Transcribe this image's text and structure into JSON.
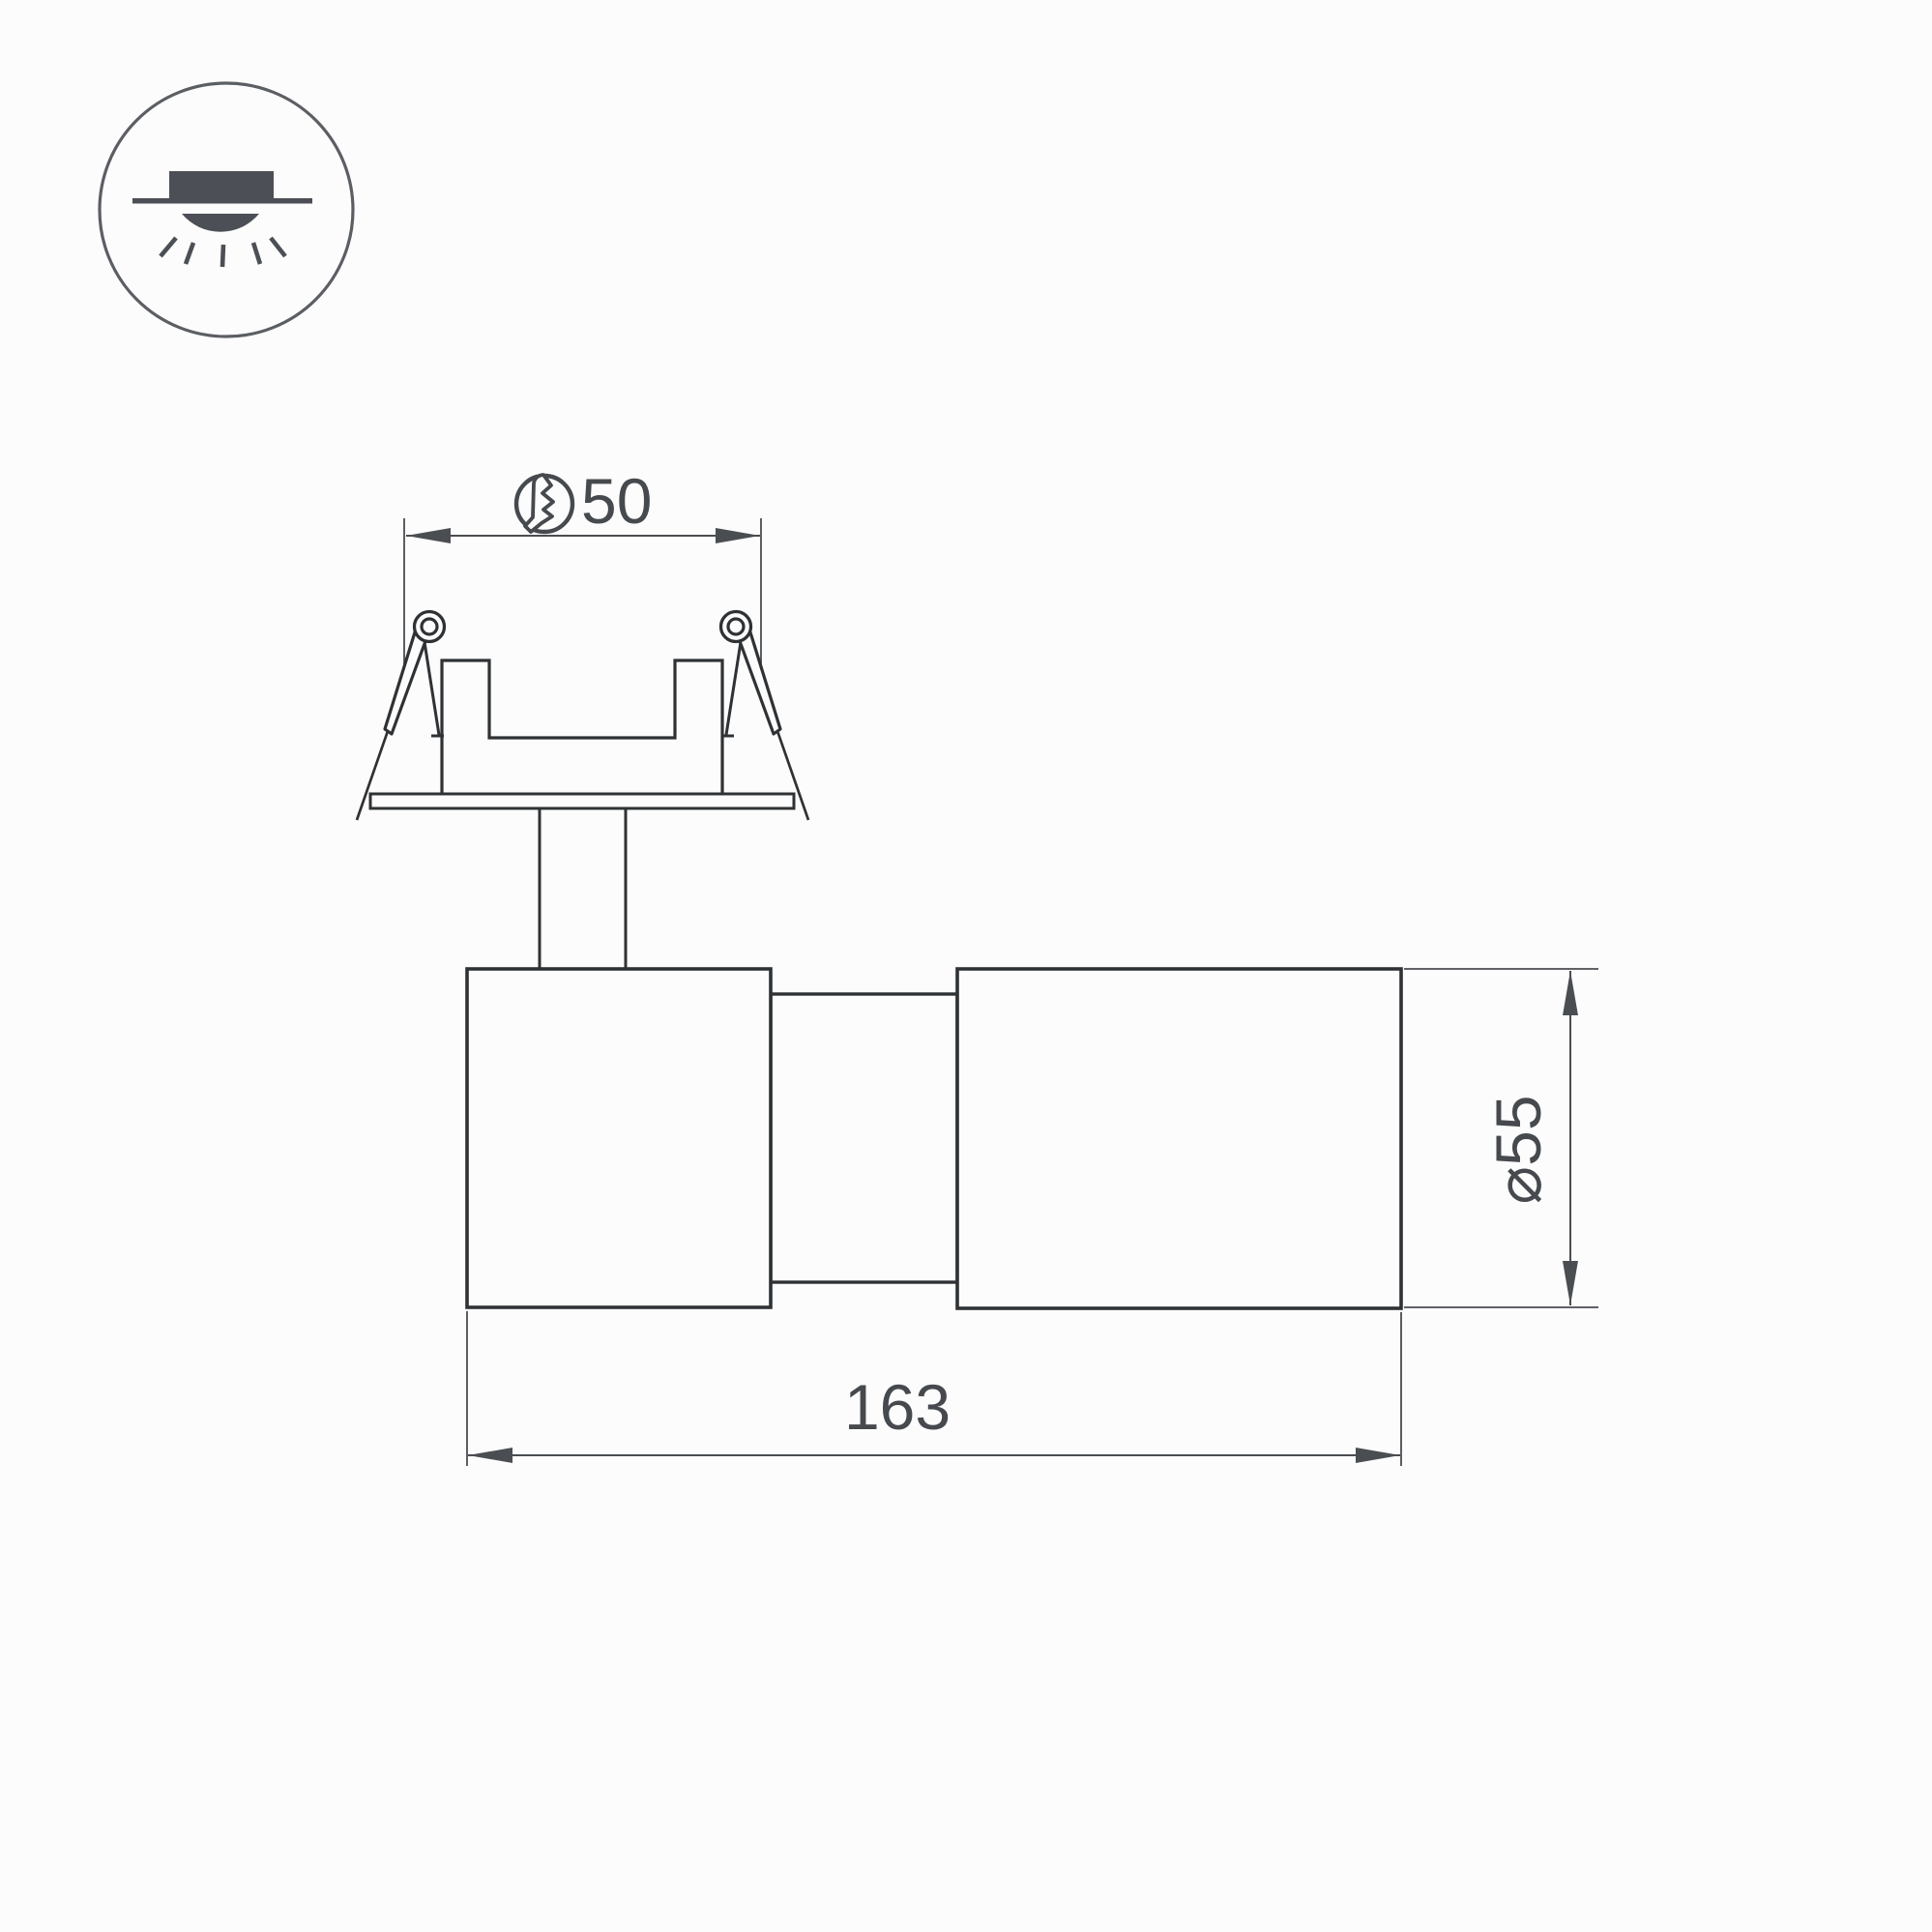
{
  "page": {
    "background": "#fcfcfc",
    "type": "technical-dimension-drawing",
    "subject": "recessed-swivel-spot-luminaire"
  },
  "colors": {
    "outline": "#2f3235",
    "dimension": "#4a4d51",
    "text": "#46494d",
    "icon": "#4c4f55",
    "icon_ring": "#5b5e63"
  },
  "icon": {
    "meaning": "recessed-ceiling-mount-indicator"
  },
  "dimensions": {
    "cutout": {
      "value": "50",
      "symbol": "cutout-hole-diameter"
    },
    "diameter": {
      "label": "⌀55"
    },
    "length": {
      "label": "163"
    }
  }
}
